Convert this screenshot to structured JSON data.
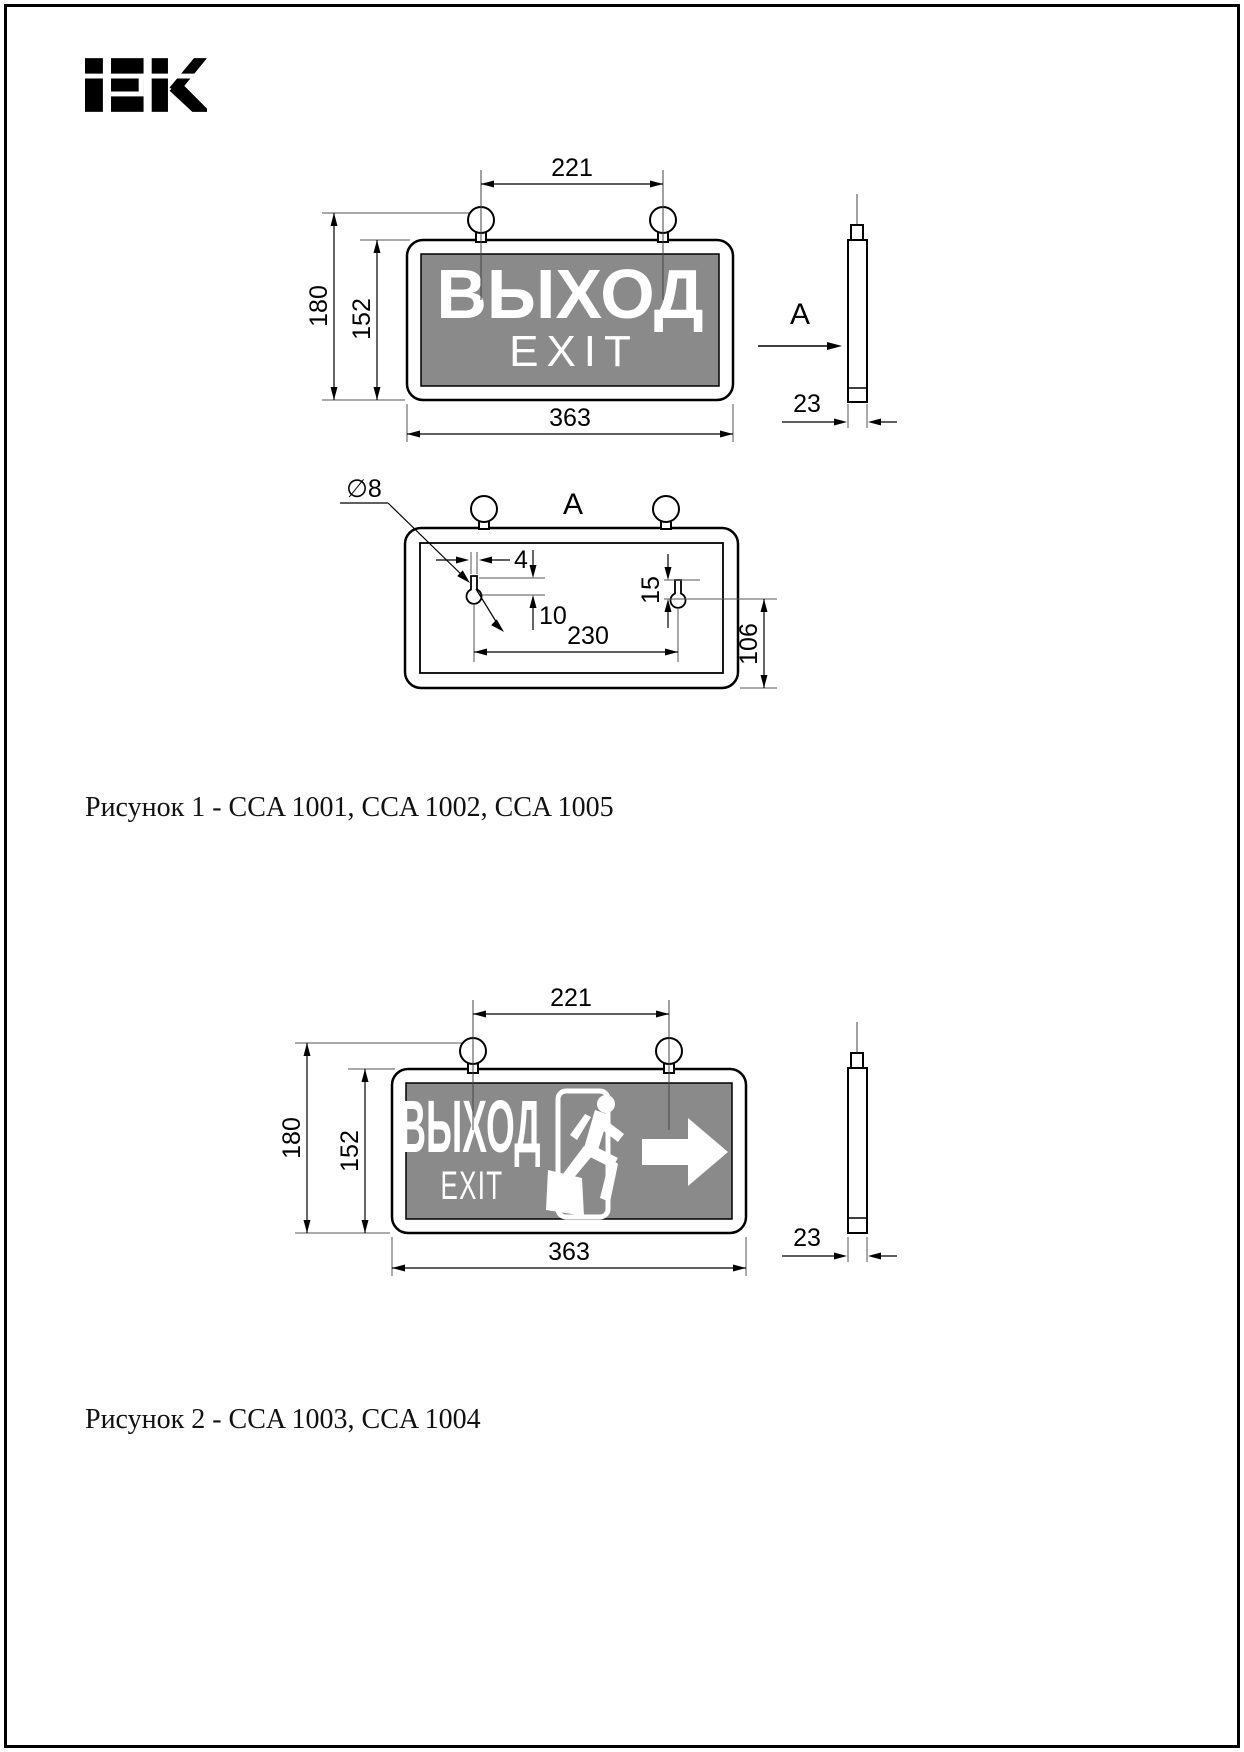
{
  "brand": {
    "logo_text": "IEK"
  },
  "figure1": {
    "caption": "Рисунок 1 - CCA 1001, CCA 1002, CCA 1005",
    "sign": {
      "line1": "ВЫХОД",
      "line2": "EXIT"
    },
    "dims": {
      "ring_span": "221",
      "overall_height": "180",
      "panel_height": "152",
      "width": "363",
      "depth": "23"
    },
    "side_view_label": "A",
    "rear_view": {
      "label": "A",
      "hole_diameter": "∅8",
      "slot_width": "4",
      "slot_offset": "10",
      "keyhole_height": "15",
      "hole_span": "230",
      "hole_vertical": "106"
    }
  },
  "figure2": {
    "caption": "Рисунок 2 - CCA 1003, CCA 1004",
    "sign": {
      "line1": "ВЫХОД",
      "line2": "EXIT"
    },
    "dims": {
      "ring_span": "221",
      "overall_height": "180",
      "panel_height": "152",
      "width": "363",
      "depth": "23"
    }
  },
  "colors": {
    "panel_gray": "#8a8a8a",
    "line_black": "#000000",
    "sign_text_white": "#ffffff"
  }
}
